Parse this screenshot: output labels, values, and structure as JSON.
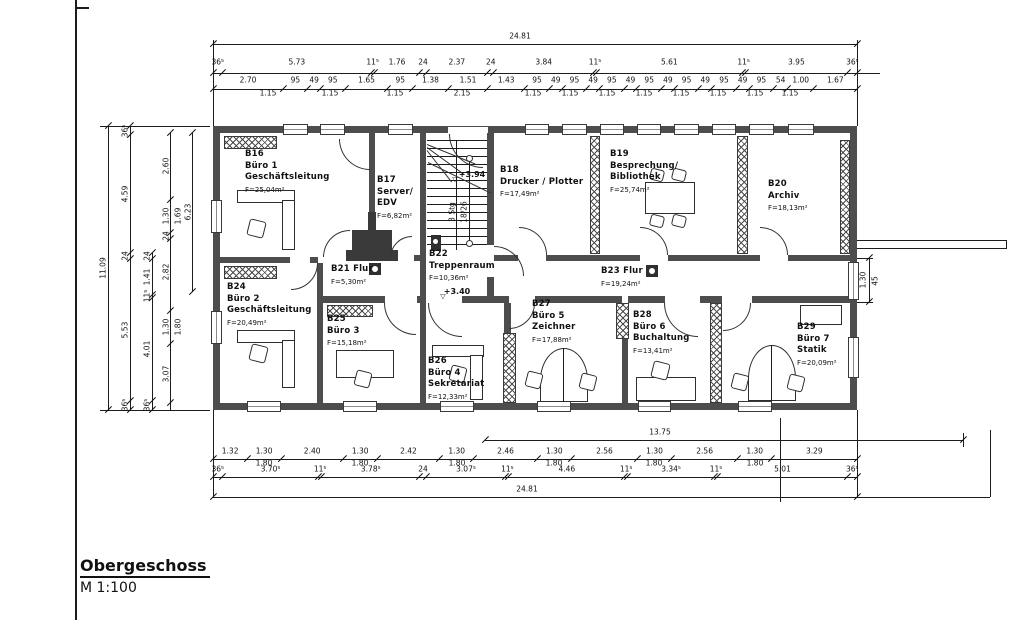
{
  "title": {
    "main": "Obergeschoss",
    "scale": "M 1:100"
  },
  "rooms": [
    {
      "id": "B16",
      "lines": [
        "B16",
        "Büro 1",
        "Geschäftsleitung"
      ],
      "area": "F=25,04m²"
    },
    {
      "id": "B17",
      "lines": [
        "B17",
        "Server/",
        "EDV"
      ],
      "area": "F=6,82m²"
    },
    {
      "id": "B18",
      "lines": [
        "B18",
        "Drucker / Plotter"
      ],
      "area": "F=17,49m²"
    },
    {
      "id": "B19",
      "lines": [
        "B19",
        "Besprechung/",
        "Bibliothek"
      ],
      "area": "F=25,74m²"
    },
    {
      "id": "B20",
      "lines": [
        "B20",
        "Archiv"
      ],
      "area": "F=18,13m²"
    },
    {
      "id": "B21",
      "lines": [
        "B21 Flur"
      ],
      "area": "F=5,30m²"
    },
    {
      "id": "B22",
      "lines": [
        "B22",
        "Treppenraum"
      ],
      "area": "F=10,36m²"
    },
    {
      "id": "B23",
      "lines": [
        "B23 Flur"
      ],
      "area": "F=19,24m²"
    },
    {
      "id": "B24",
      "lines": [
        "B24",
        "Büro 2",
        "Geschäftsleitung"
      ],
      "area": "F=20,49m²"
    },
    {
      "id": "B25",
      "lines": [
        "B25",
        "Büro 3"
      ],
      "area": "F=15,18m²"
    },
    {
      "id": "B26",
      "lines": [
        "B26",
        "Büro 4",
        "Sekretariat"
      ],
      "area": "F=12,33m²"
    },
    {
      "id": "B27",
      "lines": [
        "B27",
        "Büro 5",
        "Zeichner"
      ],
      "area": "F=17,88m²"
    },
    {
      "id": "B28",
      "lines": [
        "B28",
        "Büro 6",
        "Buchaltung"
      ],
      "area": "F=13,41m²"
    },
    {
      "id": "B29",
      "lines": [
        "B29",
        "Büro 7",
        "Statik"
      ],
      "area": "F=20,09m²"
    }
  ],
  "levels": {
    "stair_level": "+3.94",
    "corridor_level": "+3.40",
    "stair_steps": "3 Stg",
    "stair_rise": "18/26",
    "symbol": "▽"
  },
  "dims": {
    "top": {
      "overall": "24.81",
      "row2": [
        "36⁵",
        "5.73",
        "11⁵",
        "1.76",
        "24",
        "2.37",
        "24",
        "3.84",
        "11⁵",
        "5.61",
        "11⁵",
        "3.95",
        "36⁵"
      ],
      "row3": [
        "2.70",
        "95",
        "49",
        "95",
        "1.65",
        "95",
        "1.38",
        "1.51",
        "1.43",
        "95",
        "49",
        "95",
        "49",
        "95",
        "49",
        "95",
        "49",
        "95",
        "49",
        "95",
        "49",
        "95",
        "54",
        "1.00",
        "1.67"
      ],
      "row4": [
        "1.15",
        "1.15",
        "1.15",
        "2.15",
        "1.15",
        "1.15",
        "1.15",
        "1.15",
        "1.15",
        "1.15",
        "1.15",
        "1.15"
      ]
    },
    "bottom": {
      "overall": "24.81",
      "span": "13.75",
      "row1": [
        "1.32",
        "1.30",
        "2.40",
        "1.30",
        "2.42",
        "1.30",
        "2.46",
        "1.30",
        "2.56",
        "1.30",
        "2.56",
        "1.30",
        "3.29"
      ],
      "row1_sub": [
        "1.80",
        "1.80",
        "1.80",
        "1.80",
        "1.80",
        "1.80"
      ],
      "row2": [
        "36⁵",
        "3.70⁵",
        "11⁵",
        "3.78⁵",
        "24",
        "3.07⁵",
        "11⁵",
        "4.46",
        "11⁵",
        "3.34⁵",
        "11⁵",
        "5.01",
        "36⁵"
      ]
    },
    "left": {
      "overall": "11.09",
      "chain2": [
        "36⁵",
        "4.59",
        "24",
        "5.53",
        "36⁵"
      ],
      "chain3": [
        "24",
        "1.41",
        "11⁵",
        "4.01",
        "36⁵"
      ],
      "chain4": [
        "2.60",
        "1.30",
        "24",
        "2.82",
        "1.30",
        "3.07"
      ],
      "subs": [
        "1.69",
        "1.80"
      ],
      "inner": "6.23"
    },
    "right": {
      "win": "1.30",
      "win_sub": "45"
    }
  }
}
